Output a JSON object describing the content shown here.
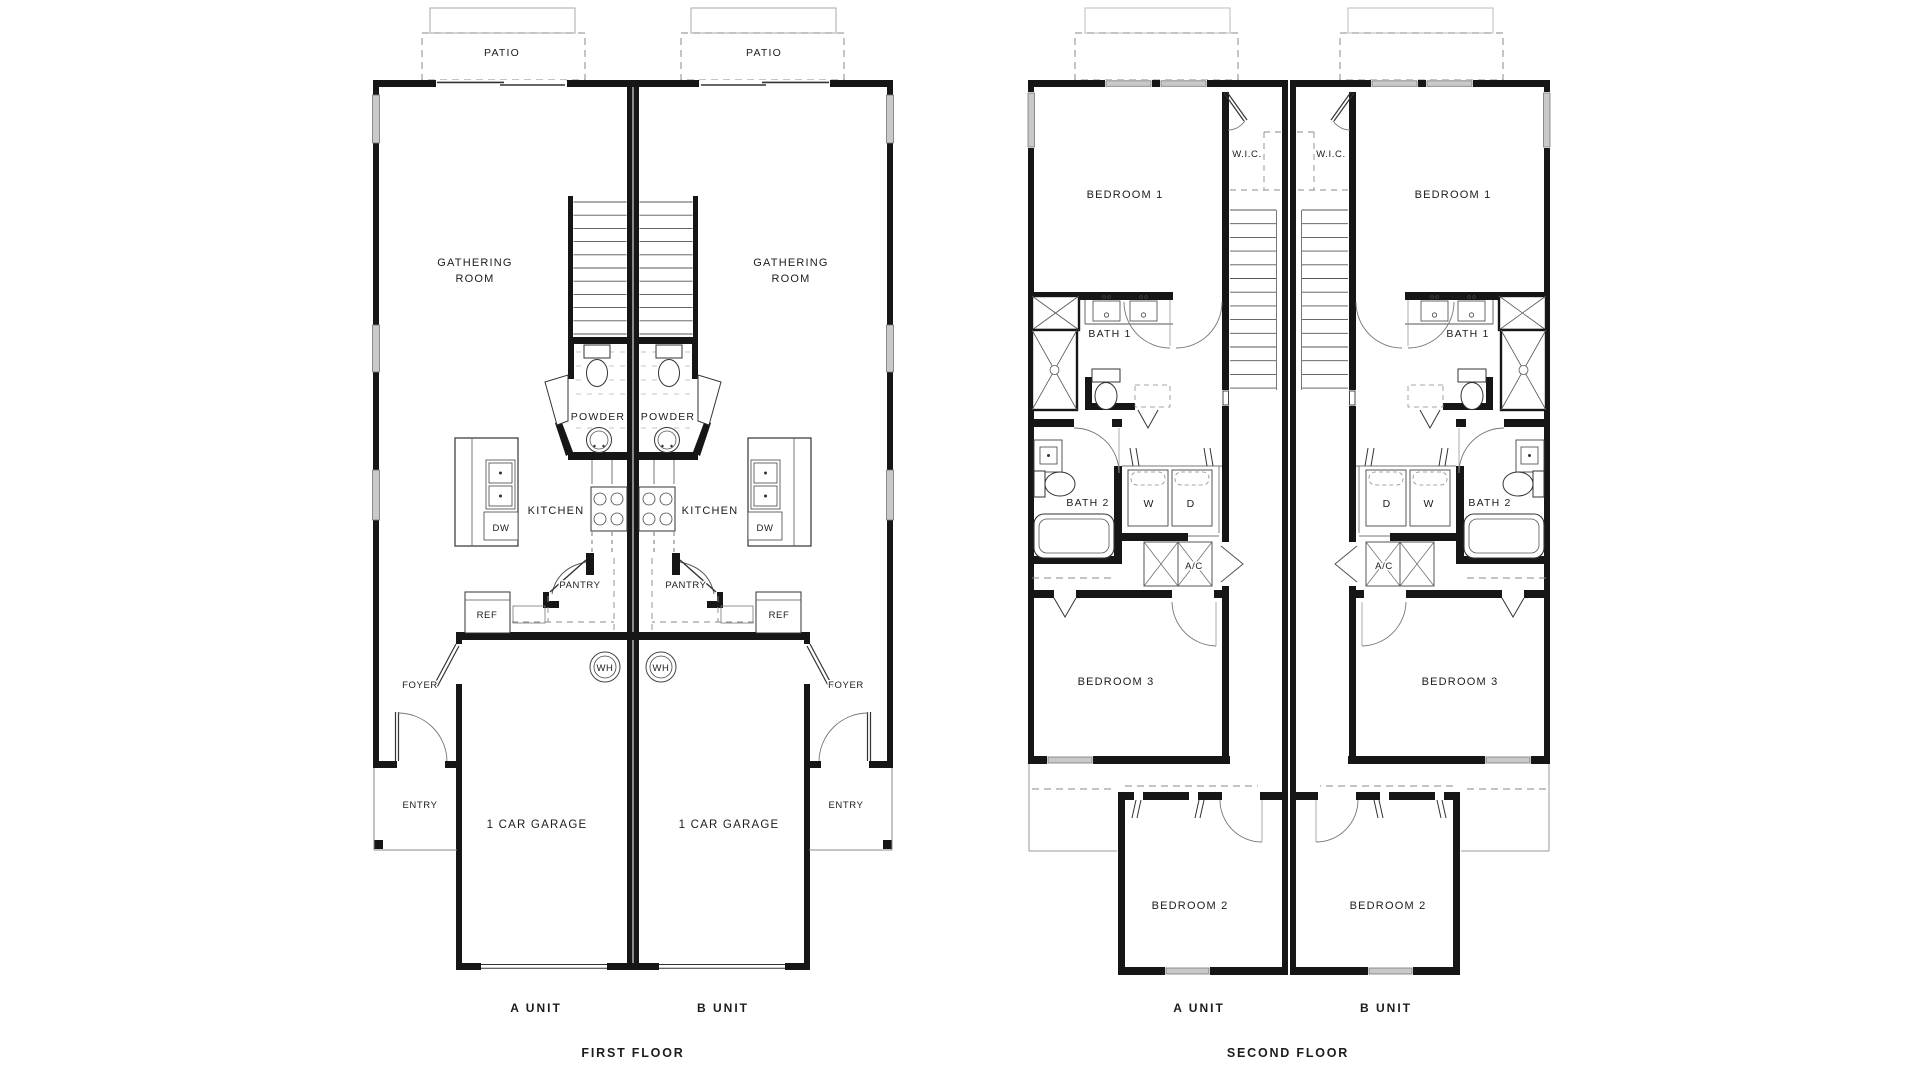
{
  "document": {
    "type": "duplex floor plan drawing",
    "background": "#ffffff",
    "wall_color": "#161616"
  },
  "first_floor": {
    "title": "FIRST FLOOR",
    "unit_a": "A UNIT",
    "unit_b": "B UNIT",
    "labels": {
      "patio": "PATIO",
      "gathering_line1": "GATHERING",
      "gathering_line2": "ROOM",
      "powder": "POWDER",
      "kitchen": "KITCHEN",
      "dw": "DW",
      "pantry": "PANTRY",
      "ref": "REF",
      "wh": "WH",
      "foyer": "FOYER",
      "entry": "ENTRY",
      "garage": "1 CAR GARAGE"
    }
  },
  "second_floor": {
    "title": "SECOND FLOOR",
    "unit_a": "A UNIT",
    "unit_b": "B UNIT",
    "labels": {
      "bedroom1": "BEDROOM 1",
      "wic": "W.I.C.",
      "bath1": "BATH 1",
      "bath2": "BATH 2",
      "washer": "W",
      "dryer": "D",
      "ac": "A/C",
      "bedroom3": "BEDROOM 3",
      "bedroom2": "BEDROOM 2"
    }
  }
}
